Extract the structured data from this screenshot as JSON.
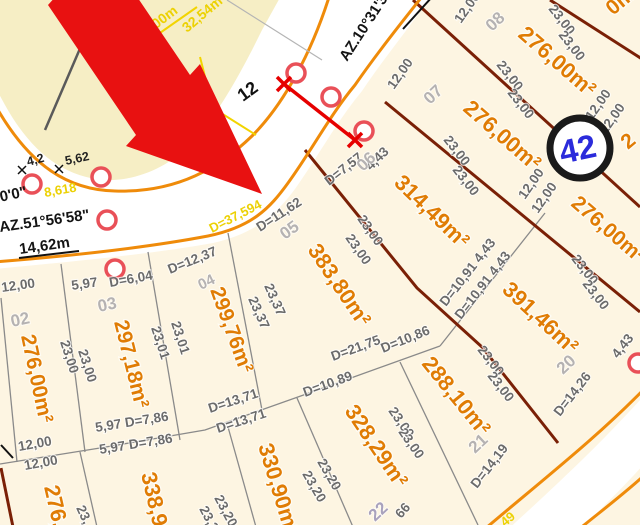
{
  "block": {
    "badge": "42"
  },
  "street_labels": {
    "azimuth_upper": "AZ.10°31'3",
    "azimuth_left_partial": "°0'0\"",
    "azimuth_left": "AZ.51°56'58\"",
    "width_left": "14,62m",
    "width_marker": "12",
    "curve_small": "8,618",
    "curve_main": "D=37,594",
    "arc_length": "32,54m",
    "radius": "R=45,00m",
    "tick_a": "4,2",
    "tick_b": "5,62",
    "bottom_partial": "49"
  },
  "lot_numbers": [
    "02",
    "03",
    "04",
    "05",
    "06",
    "07",
    "08",
    "20",
    "21",
    "22"
  ],
  "areas": [
    "276,00m²",
    "297,18m²",
    "299,76m²",
    "383,80m²",
    "314,49m²",
    "276,00m²",
    "276,00m²",
    "276,00m²",
    "391,46m²",
    "288,10m²",
    "328,29m²",
    "330,90m²",
    "338,9",
    "276,",
    "0m",
    "2"
  ],
  "dims": [
    "12,00",
    "5,97",
    "D=6,04",
    "D=12,37",
    "D=11,62",
    "D=7,57",
    "4,43",
    "12,00",
    "12,00",
    "23,00",
    "23,00",
    "23,01",
    "23,01",
    "23,37",
    "23,37",
    "23,00",
    "23,00",
    "23,00",
    "23,00",
    "23,00",
    "23,00",
    "23,00",
    "23,00",
    "12,00",
    "12,00",
    "12,00",
    "12,00",
    "23,00",
    "23,00",
    "D=10,91 4,43",
    "D=10,91 4,43",
    "23,00",
    "23,00",
    "D=14,26",
    "D=14,19",
    "4,43",
    "23,00",
    "23,00",
    "23,20",
    "23,20",
    "23,20",
    "23,20",
    "23,",
    "5,97 D=7,86",
    "5,97 D=7,86",
    "12,00",
    "12,00",
    "D=13,71",
    "D=13,71",
    "D=10,89",
    "D=21,75",
    "D=10,86",
    "66"
  ],
  "colors": {
    "curb_orange": "#ef8b0a",
    "maroon": "#7a2006",
    "arrow_red": "#e81111",
    "survey_ring": "#e95058",
    "label_yellow": "#ecd104",
    "dim_gray": "#6b6b6b",
    "lot_number_gray": "#b5b2b2",
    "area_orange": "#e07c04",
    "badge_blue": "#2b2bdb",
    "block_cream": "#fdf5e2",
    "block_yellow": "#f6eec5"
  }
}
